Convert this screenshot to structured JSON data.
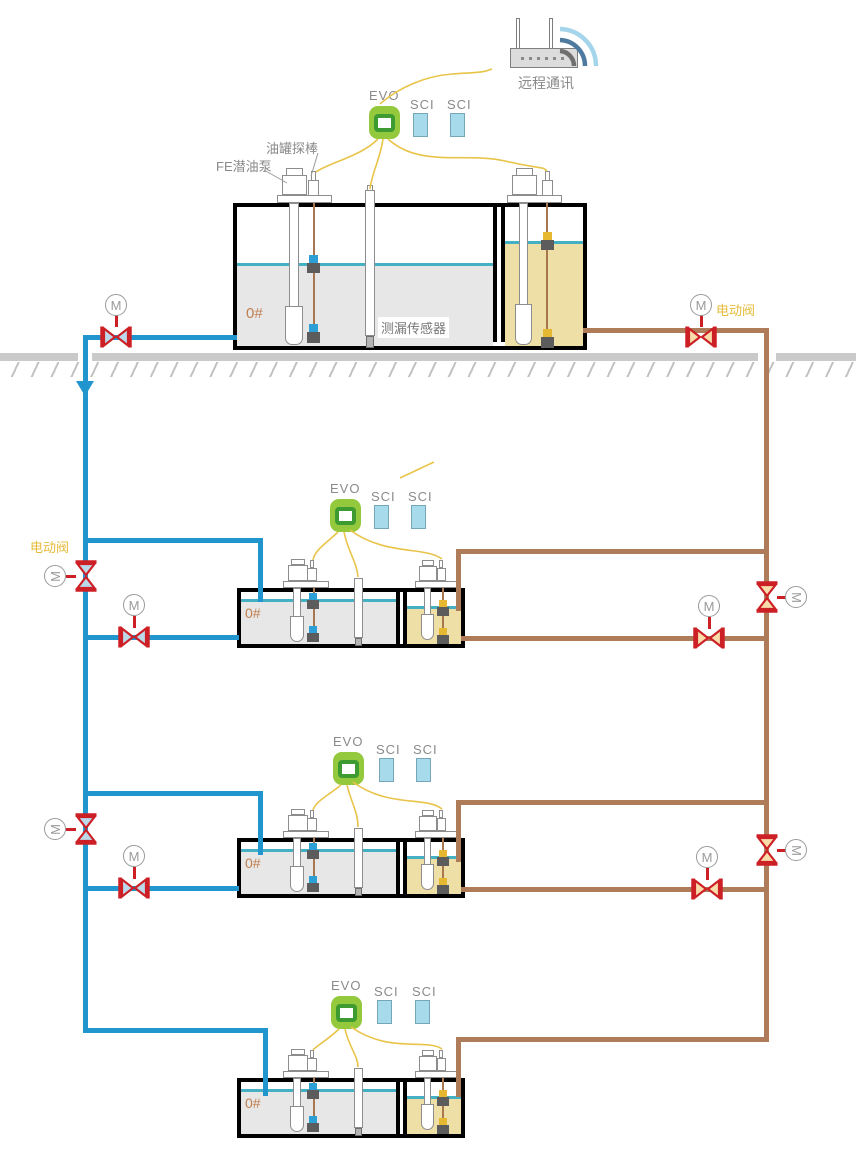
{
  "labels": {
    "remote_comm": "远程通讯",
    "console": "EVO",
    "interface": "SCI",
    "tank_probe": "油罐探棒",
    "fe_pump": "FE潜油泵",
    "leak_sensor": "测漏传感器",
    "electric_valve": "电动阀",
    "fuel_grade": "0#",
    "motor": "M"
  },
  "colors": {
    "pipe_blue": "#2095ce",
    "pipe_brown": "#ae7c58",
    "wire_yellow": "#e9c44a",
    "valve_red": "#cd2026",
    "valve_fill_blue": "#bcd9ea",
    "valve_fill_tan": "#f8ddab",
    "evo_green": "#94c93d",
    "evo_ring_green": "#3e9b31",
    "sci_blue": "#a7dbeb",
    "liquid_gray": "#e7e7e7",
    "liquid_yellow": "#eedfa6",
    "liquid_line_teal": "#45b0c4",
    "ground_gray": "#cacaca",
    "label_gray": "#8a8a8a",
    "grade_orange": "#bf7f50",
    "electric_valve_label_yellow": "#e5bb3a"
  },
  "structure": {
    "tank_groups": 4,
    "motor_valves": 10,
    "consoles": 4,
    "interfaces_per_console": 2
  }
}
